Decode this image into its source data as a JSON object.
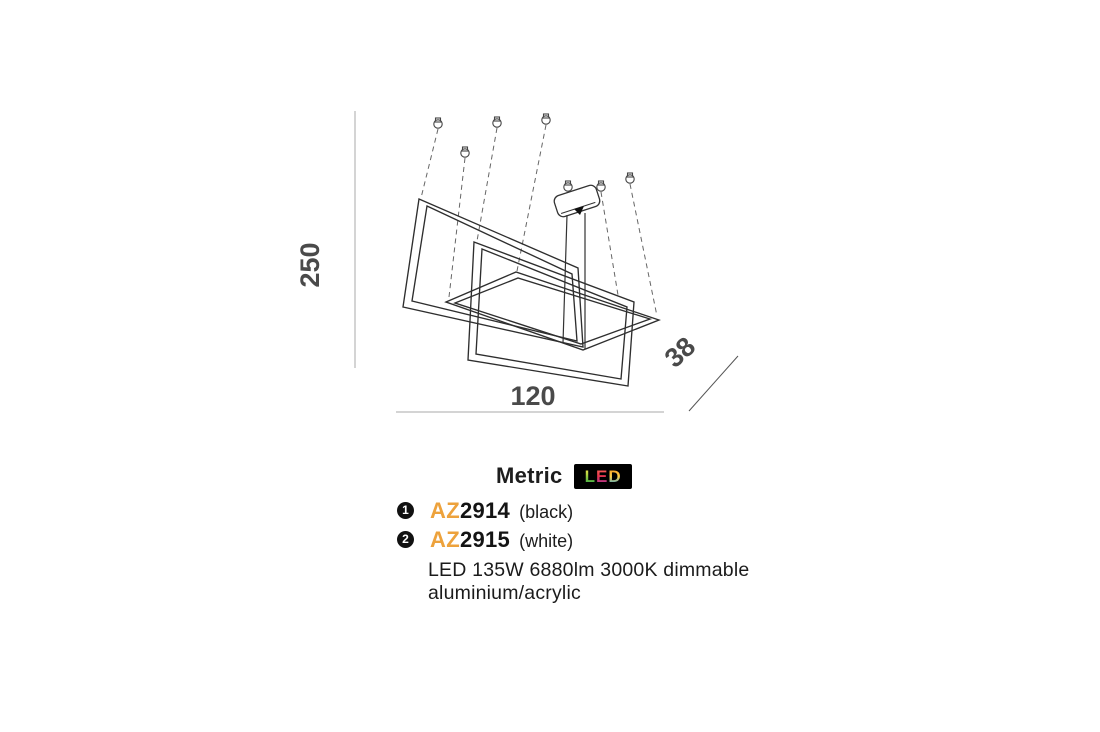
{
  "drawing": {
    "height_label": "250",
    "width_label": "120",
    "depth_label": "38"
  },
  "header": {
    "title": "Metric",
    "led_letters": [
      "L",
      "E",
      "D"
    ]
  },
  "products": [
    {
      "index": "1",
      "prefix": "AZ",
      "code": "2914",
      "variant": "(black)"
    },
    {
      "index": "2",
      "prefix": "AZ",
      "code": "2915",
      "variant": "(white)"
    }
  ],
  "specs": {
    "line1": "LED 135W 6880lm 3000K dimmable",
    "line2": "aluminium/acrylic"
  },
  "colors": {
    "accent_orange": "#EDA23C",
    "outline": "#2e2e2e",
    "dimension_line": "#a8a8a8",
    "dimension_text": "#4a4a4a",
    "led_badge_bg": "#000000"
  }
}
